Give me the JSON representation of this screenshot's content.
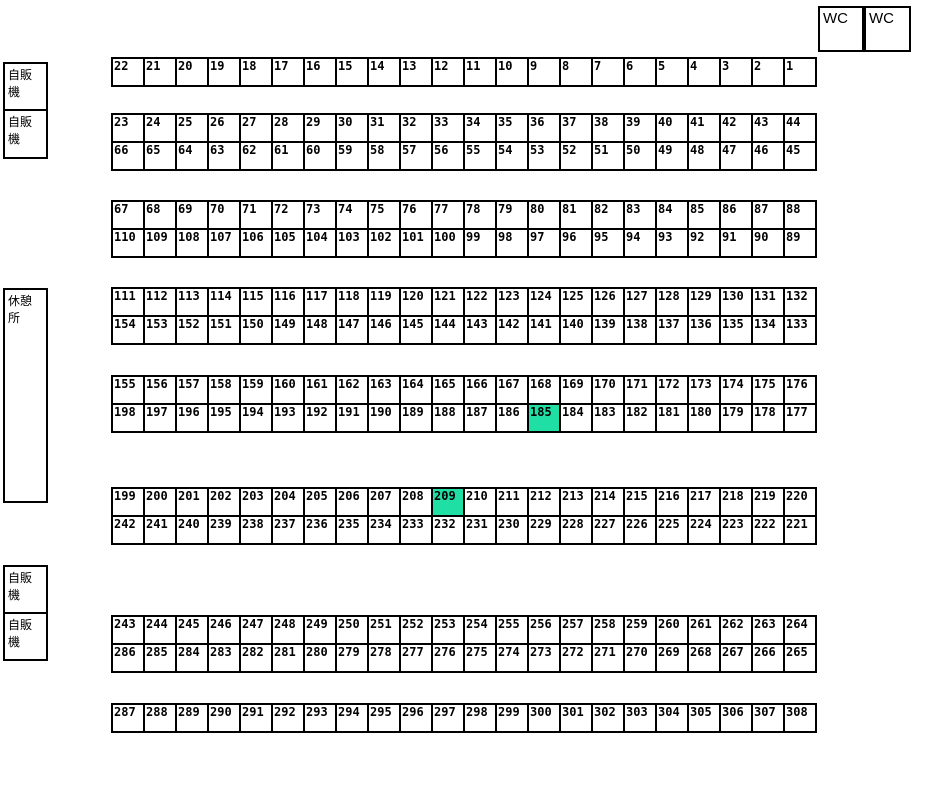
{
  "map": {
    "highlight_color": "#20DFA4",
    "highlighted_cells": [
      "185",
      "209"
    ],
    "facilities": {
      "wc_1": "WC",
      "wc_2": "WC",
      "vending_machine_1": "自販機",
      "vending_machine_2": "自販機",
      "rest_area": "休憩所",
      "vending_machine_3": "自販機",
      "vending_machine_4": "自販機"
    },
    "blocks": [
      {
        "rows": [
          [
            "22",
            "21",
            "20",
            "19",
            "18",
            "17",
            "16",
            "15",
            "14",
            "13",
            "12",
            "11",
            "10",
            "9",
            "8",
            "7",
            "6",
            "5",
            "4",
            "3",
            "2",
            "1"
          ]
        ]
      },
      {
        "rows": [
          [
            "23",
            "24",
            "25",
            "26",
            "27",
            "28",
            "29",
            "30",
            "31",
            "32",
            "33",
            "34",
            "35",
            "36",
            "37",
            "38",
            "39",
            "40",
            "41",
            "42",
            "43",
            "44"
          ],
          [
            "66",
            "65",
            "64",
            "63",
            "62",
            "61",
            "60",
            "59",
            "58",
            "57",
            "56",
            "55",
            "54",
            "53",
            "52",
            "51",
            "50",
            "49",
            "48",
            "47",
            "46",
            "45"
          ]
        ]
      },
      {
        "rows": [
          [
            "67",
            "68",
            "69",
            "70",
            "71",
            "72",
            "73",
            "74",
            "75",
            "76",
            "77",
            "78",
            "79",
            "80",
            "81",
            "82",
            "83",
            "84",
            "85",
            "86",
            "87",
            "88"
          ],
          [
            "110",
            "109",
            "108",
            "107",
            "106",
            "105",
            "104",
            "103",
            "102",
            "101",
            "100",
            "99",
            "98",
            "97",
            "96",
            "95",
            "94",
            "93",
            "92",
            "91",
            "90",
            "89"
          ]
        ]
      },
      {
        "rows": [
          [
            "111",
            "112",
            "113",
            "114",
            "115",
            "116",
            "117",
            "118",
            "119",
            "120",
            "121",
            "122",
            "123",
            "124",
            "125",
            "126",
            "127",
            "128",
            "129",
            "130",
            "131",
            "132"
          ],
          [
            "154",
            "153",
            "152",
            "151",
            "150",
            "149",
            "148",
            "147",
            "146",
            "145",
            "144",
            "143",
            "142",
            "141",
            "140",
            "139",
            "138",
            "137",
            "136",
            "135",
            "134",
            "133"
          ]
        ]
      },
      {
        "rows": [
          [
            "155",
            "156",
            "157",
            "158",
            "159",
            "160",
            "161",
            "162",
            "163",
            "164",
            "165",
            "166",
            "167",
            "168",
            "169",
            "170",
            "171",
            "172",
            "173",
            "174",
            "175",
            "176"
          ],
          [
            "198",
            "197",
            "196",
            "195",
            "194",
            "193",
            "192",
            "191",
            "190",
            "189",
            "188",
            "187",
            "186",
            "185",
            "184",
            "183",
            "182",
            "181",
            "180",
            "179",
            "178",
            "177"
          ]
        ]
      },
      {
        "rows": [
          [
            "199",
            "200",
            "201",
            "202",
            "203",
            "204",
            "205",
            "206",
            "207",
            "208",
            "209",
            "210",
            "211",
            "212",
            "213",
            "214",
            "215",
            "216",
            "217",
            "218",
            "219",
            "220"
          ],
          [
            "242",
            "241",
            "240",
            "239",
            "238",
            "237",
            "236",
            "235",
            "234",
            "233",
            "232",
            "231",
            "230",
            "229",
            "228",
            "227",
            "226",
            "225",
            "224",
            "223",
            "222",
            "221"
          ]
        ]
      },
      {
        "rows": [
          [
            "243",
            "244",
            "245",
            "246",
            "247",
            "248",
            "249",
            "250",
            "251",
            "252",
            "253",
            "254",
            "255",
            "256",
            "257",
            "258",
            "259",
            "260",
            "261",
            "262",
            "263",
            "264"
          ],
          [
            "286",
            "285",
            "284",
            "283",
            "282",
            "281",
            "280",
            "279",
            "278",
            "277",
            "276",
            "275",
            "274",
            "273",
            "272",
            "271",
            "270",
            "269",
            "268",
            "267",
            "266",
            "265"
          ]
        ]
      },
      {
        "rows": [
          [
            "287",
            "288",
            "289",
            "290",
            "291",
            "292",
            "293",
            "294",
            "295",
            "296",
            "297",
            "298",
            "299",
            "300",
            "301",
            "302",
            "303",
            "304",
            "305",
            "306",
            "307",
            "308"
          ]
        ]
      }
    ]
  }
}
